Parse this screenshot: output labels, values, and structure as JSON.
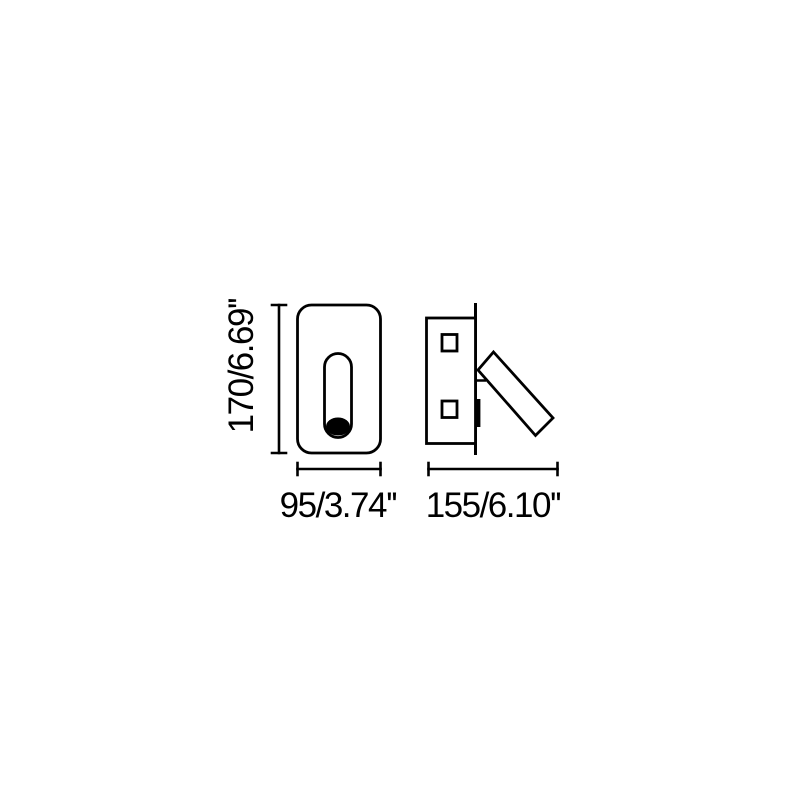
{
  "diagram_type": "product-dimension-drawing",
  "colors": {
    "background": "#ffffff",
    "line": "#000000"
  },
  "labels": {
    "front_height": "170/6.69''",
    "front_width": "95/3.74''",
    "side_depth": "155/6.10''"
  }
}
